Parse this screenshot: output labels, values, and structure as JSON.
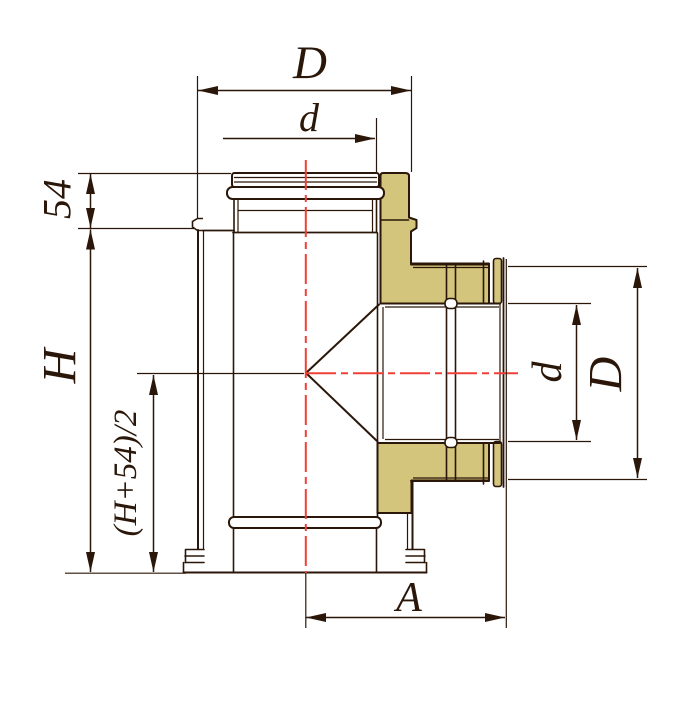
{
  "drawing": {
    "type": "technical-drawing",
    "subject": "insulated-chimney-tee-fitting",
    "labels": {
      "top_outer_diameter": "D",
      "top_inner_diameter": "d",
      "collar_height": "54",
      "total_height": "H",
      "branch_axis_height": "(H+54)/2",
      "branch_length": "A",
      "branch_inner_diameter": "d",
      "branch_outer_diameter": "D"
    },
    "colors": {
      "line": "#2b1709",
      "centerline": "#ee4035",
      "insulation": "#d3c57b",
      "background": "#ffffff"
    }
  }
}
